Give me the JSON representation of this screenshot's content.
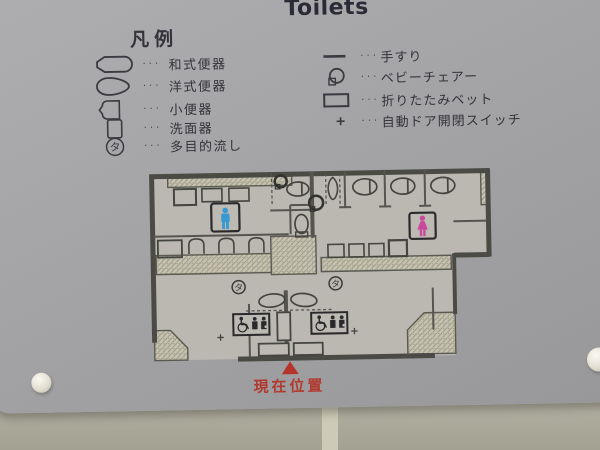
{
  "header": {
    "title": "Toilets"
  },
  "legend": {
    "header": "凡例",
    "dots": "···",
    "left_items": [
      {
        "icon": "squat-toilet-icon",
        "label": "和式便器"
      },
      {
        "icon": "western-toilet-icon",
        "label": "洋式便器"
      },
      {
        "icon": "urinal-icon",
        "label": "小便器"
      },
      {
        "icon": "washbasin-icon",
        "label": "洗面器"
      },
      {
        "icon": "multipurpose-sink-icon",
        "label": "多目的流し"
      }
    ],
    "right_items": [
      {
        "icon": "handrail-icon",
        "label": "手すり"
      },
      {
        "icon": "baby-chair-icon",
        "label": "ベビーチェアー"
      },
      {
        "icon": "folding-bed-icon",
        "label": "折りたたみベット"
      },
      {
        "icon": "auto-door-switch-icon",
        "label": "自動ドア開閉スイッチ"
      }
    ]
  },
  "plan": {
    "multipurpose_symbol": "タ",
    "current_location_label": "現在位置",
    "men_symbol_color": "#3a99d0",
    "women_symbol_color": "#c9489b",
    "marker_color": "#b5342c"
  }
}
